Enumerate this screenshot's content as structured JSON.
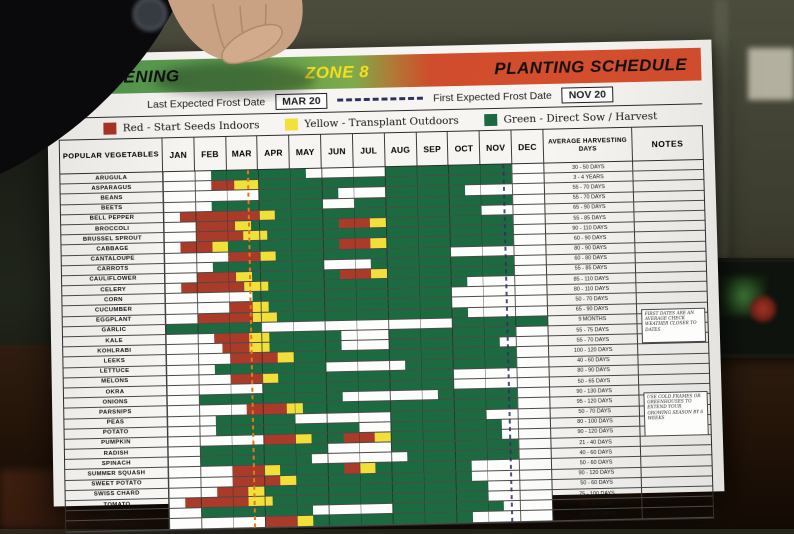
{
  "poster": {
    "header": {
      "brand": "GARDENING",
      "zone": "ZONE 8",
      "title": "PLANTING SCHEDULE"
    },
    "frost_row": {
      "last_label": "Last Expected Frost Date",
      "last_value": "MAR 20",
      "first_label": "First Expected Frost Date",
      "first_value": "NOV 20"
    },
    "legend": {
      "items": [
        {
          "key": "red",
          "color": "#ab3526",
          "label": "Red - Start Seeds Indoors"
        },
        {
          "key": "yellow",
          "color": "#f2e13c",
          "label": "Yellow - Transplant Outdoors"
        },
        {
          "key": "green",
          "color": "#1c6b40",
          "label": "Green - Direct Sow / Harvest"
        }
      ]
    }
  },
  "chart_data": {
    "type": "table",
    "title": "GARDENING ZONE 8 PLANTING SCHEDULE",
    "columns": {
      "vegetable": "POPULAR VEGETABLES",
      "harvest": "AVERAGE HARVESTING DAYS",
      "notes": "NOTES"
    },
    "categories": [
      "JAN",
      "FEB",
      "MAR",
      "APR",
      "MAY",
      "JUN",
      "JUL",
      "AUG",
      "SEP",
      "OCT",
      "NOV",
      "DEC"
    ],
    "legend_meaning": {
      "red": "Start Seeds Indoors",
      "yellow": "Transplant Outdoors",
      "green": "Direct Sow / Harvest"
    },
    "frost_dates": {
      "last": "MAR 20",
      "first": "NOV 20"
    },
    "frost_line_months": {
      "last": 3.65,
      "first": 11.65
    },
    "axis": {
      "scale": "months",
      "start": 1,
      "end": 13
    },
    "colors": {
      "R": "#a93b28",
      "Y": "#f2e03a",
      "G": "#1c6b40"
    },
    "rows": [
      {
        "veg": "ARUGULA",
        "days": "30 - 50 DAYS",
        "bars": [
          [
            "G",
            2.5,
            5.5
          ],
          [
            "G",
            8,
            12
          ]
        ]
      },
      {
        "veg": "ASPARAGUS",
        "days": "3 - 4 YEARS",
        "bars": [
          [
            "R",
            2.5,
            3.25
          ],
          [
            "Y",
            3.25,
            4
          ],
          [
            "G",
            4,
            12
          ]
        ]
      },
      {
        "veg": "BEANS",
        "days": "55 - 70 DAYS",
        "bars": [
          [
            "G",
            4,
            6.5
          ],
          [
            "G",
            8,
            10.5
          ]
        ]
      },
      {
        "veg": "BEETS",
        "days": "55 - 70 DAYS",
        "bars": [
          [
            "G",
            2.5,
            6
          ],
          [
            "G",
            7,
            12
          ]
        ]
      },
      {
        "veg": "BELL PEPPER",
        "days": "65 - 90 DAYS",
        "bars": [
          [
            "R",
            1.5,
            4
          ],
          [
            "Y",
            4,
            4.5
          ],
          [
            "G",
            4.5,
            11
          ]
        ]
      },
      {
        "veg": "BROCCOLI",
        "days": "55 - 85 DAYS",
        "bars": [
          [
            "R",
            2,
            3.25
          ],
          [
            "Y",
            3.25,
            3.75
          ],
          [
            "G",
            3.75,
            6.5
          ],
          [
            "R",
            6.5,
            7.5
          ],
          [
            "Y",
            7.5,
            8
          ],
          [
            "G",
            8,
            12
          ]
        ]
      },
      {
        "veg": "BRUSSEL SPROUT",
        "days": "90 - 110 DAYS",
        "bars": [
          [
            "R",
            2,
            3.5
          ],
          [
            "Y",
            3.5,
            4.25
          ],
          [
            "G",
            4.25,
            12
          ]
        ]
      },
      {
        "veg": "CABBAGE",
        "days": "60 - 90 DAYS",
        "bars": [
          [
            "R",
            1.5,
            2.5
          ],
          [
            "Y",
            2.5,
            3
          ],
          [
            "G",
            3,
            6.5
          ],
          [
            "R",
            6.5,
            7.5
          ],
          [
            "Y",
            7.5,
            8
          ],
          [
            "G",
            8,
            12
          ]
        ]
      },
      {
        "veg": "CANTALOUPE",
        "days": "80 - 90 DAYS",
        "bars": [
          [
            "R",
            3,
            4
          ],
          [
            "Y",
            4,
            4.5
          ],
          [
            "G",
            4.5,
            10
          ]
        ]
      },
      {
        "veg": "CARROTS",
        "days": "60 - 80 DAYS",
        "bars": [
          [
            "G",
            2.5,
            6
          ],
          [
            "G",
            7.5,
            12
          ]
        ]
      },
      {
        "veg": "CAULIFLOWER",
        "days": "55 - 85 DAYS",
        "bars": [
          [
            "R",
            2,
            3.25
          ],
          [
            "Y",
            3.25,
            3.75
          ],
          [
            "G",
            3.75,
            6.5
          ],
          [
            "R",
            6.5,
            7.5
          ],
          [
            "Y",
            7.5,
            8
          ],
          [
            "G",
            8,
            12
          ]
        ]
      },
      {
        "veg": "CELERY",
        "days": "85 - 110 DAYS",
        "bars": [
          [
            "R",
            1.5,
            3.5
          ],
          [
            "Y",
            3.5,
            4.25
          ],
          [
            "G",
            4.25,
            10.5
          ]
        ]
      },
      {
        "veg": "CORN",
        "days": "80 - 110 DAYS",
        "bars": [
          [
            "G",
            3.75,
            10
          ]
        ]
      },
      {
        "veg": "CUCUMBER",
        "days": "50 - 70 DAYS",
        "bars": [
          [
            "R",
            3,
            3.75
          ],
          [
            "Y",
            3.75,
            4.25
          ],
          [
            "G",
            4.25,
            10
          ]
        ]
      },
      {
        "veg": "EGGPLANT",
        "days": "65 - 90 DAYS",
        "bars": [
          [
            "R",
            2,
            3.75
          ],
          [
            "Y",
            3.75,
            4.5
          ],
          [
            "G",
            4.5,
            10.5
          ]
        ]
      },
      {
        "veg": "GARLIC",
        "days": "9 MONTHS",
        "bars": [
          [
            "G",
            1,
            4
          ],
          [
            "G",
            10,
            13
          ]
        ]
      },
      {
        "veg": "KALE",
        "days": "55 - 75 DAYS",
        "bars": [
          [
            "R",
            2.5,
            3.6
          ],
          [
            "Y",
            3.6,
            4.25
          ],
          [
            "G",
            4.25,
            6.5
          ],
          [
            "G",
            8,
            12
          ]
        ]
      },
      {
        "veg": "KOHLRABI",
        "days": "55 - 70 DAYS",
        "bars": [
          [
            "R",
            2.75,
            3.6
          ],
          [
            "Y",
            3.6,
            4.25
          ],
          [
            "G",
            4.25,
            6.5
          ],
          [
            "G",
            8,
            11.5
          ]
        ]
      },
      {
        "veg": "LEEKS",
        "days": "100 - 120 DAYS",
        "bars": [
          [
            "R",
            3,
            4.5
          ],
          [
            "Y",
            4.5,
            5
          ],
          [
            "G",
            5,
            12
          ]
        ]
      },
      {
        "veg": "LETTUCE",
        "days": "40 - 60 DAYS",
        "bars": [
          [
            "G",
            2.5,
            6
          ],
          [
            "G",
            8.5,
            12
          ]
        ]
      },
      {
        "veg": "MELONS",
        "days": "80 - 90 DAYS",
        "bars": [
          [
            "R",
            3,
            4
          ],
          [
            "Y",
            4,
            4.5
          ],
          [
            "G",
            4.5,
            10
          ]
        ]
      },
      {
        "veg": "OKRA",
        "days": "50 - 65 DAYS",
        "bars": [
          [
            "G",
            4,
            10
          ]
        ]
      },
      {
        "veg": "ONIONS",
        "days": "90 - 130 DAYS",
        "bars": [
          [
            "G",
            2,
            6.5
          ],
          [
            "G",
            9.5,
            12
          ]
        ]
      },
      {
        "veg": "PARSNIPS",
        "days": "95 - 120 DAYS",
        "bars": [
          [
            "R",
            3.5,
            4.75
          ],
          [
            "Y",
            4.75,
            5.25
          ],
          [
            "G",
            5.25,
            12
          ]
        ]
      },
      {
        "veg": "PEAS",
        "days": "50 - 70 DAYS",
        "bars": [
          [
            "G",
            2.5,
            5
          ],
          [
            "G",
            8,
            11
          ]
        ]
      },
      {
        "veg": "POTATO",
        "days": "80 - 100 DAYS",
        "bars": [
          [
            "G",
            2.5,
            7
          ],
          [
            "G",
            8,
            11.5
          ]
        ]
      },
      {
        "veg": "PUMPKIN",
        "days": "90 - 120 DAYS",
        "bars": [
          [
            "R",
            4,
            5
          ],
          [
            "Y",
            5,
            5.5
          ],
          [
            "G",
            5.5,
            6.5
          ],
          [
            "R",
            6.5,
            7.5
          ],
          [
            "Y",
            7.5,
            8
          ],
          [
            "G",
            8,
            11.5
          ]
        ]
      },
      {
        "veg": "RADISH",
        "days": "21 - 40 DAYS",
        "bars": [
          [
            "G",
            2,
            6
          ],
          [
            "G",
            8,
            12
          ]
        ]
      },
      {
        "veg": "SPINACH",
        "days": "40 - 60 DAYS",
        "bars": [
          [
            "G",
            2,
            5.5
          ],
          [
            "G",
            8.5,
            12
          ]
        ]
      },
      {
        "veg": "SUMMER SQUASH",
        "days": "50 - 60 DAYS",
        "bars": [
          [
            "R",
            3,
            4
          ],
          [
            "Y",
            4,
            4.5
          ],
          [
            "G",
            4.5,
            6.5
          ],
          [
            "R",
            6.5,
            7
          ],
          [
            "Y",
            7,
            7.5
          ],
          [
            "G",
            7.5,
            10.5
          ]
        ]
      },
      {
        "veg": "SWEET POTATO",
        "days": "90 - 120 DAYS",
        "bars": [
          [
            "R",
            3,
            4.5
          ],
          [
            "Y",
            4.5,
            5
          ],
          [
            "G",
            5,
            10.5
          ]
        ]
      },
      {
        "veg": "SWISS CHARD",
        "days": "50 - 60 DAYS",
        "bars": [
          [
            "R",
            2.5,
            3.5
          ],
          [
            "Y",
            3.5,
            4
          ],
          [
            "G",
            4,
            11
          ]
        ]
      },
      {
        "veg": "TOMATO",
        "days": "75 - 100 DAYS",
        "bars": [
          [
            "R",
            1.5,
            3.5
          ],
          [
            "Y",
            3.5,
            4.25
          ],
          [
            "G",
            4.25,
            11
          ]
        ]
      },
      {
        "veg": "TURNIP",
        "days": "30 - 45 DAYS",
        "bars": [
          [
            "G",
            2,
            5.5
          ],
          [
            "G",
            8,
            11.5
          ]
        ]
      },
      {
        "veg": "WINTER SQUASH",
        "days": "95 - 115 DAYS",
        "bars": [
          [
            "R",
            4,
            5
          ],
          [
            "Y",
            5,
            5.5
          ],
          [
            "G",
            5.5,
            10.5
          ]
        ]
      }
    ],
    "notes": [
      {
        "text": "FIRST DATES ARE AN AVERAGE CHECK WEATHER CLOSER TO DATES",
        "row": 16,
        "span": 4
      },
      {
        "text": "USE COLD FRAMES OR GREENHOUSES TO EXTEND YOUR GROWING SEASON BY 6 WEEKS",
        "row": 25,
        "span": 5
      }
    ]
  }
}
